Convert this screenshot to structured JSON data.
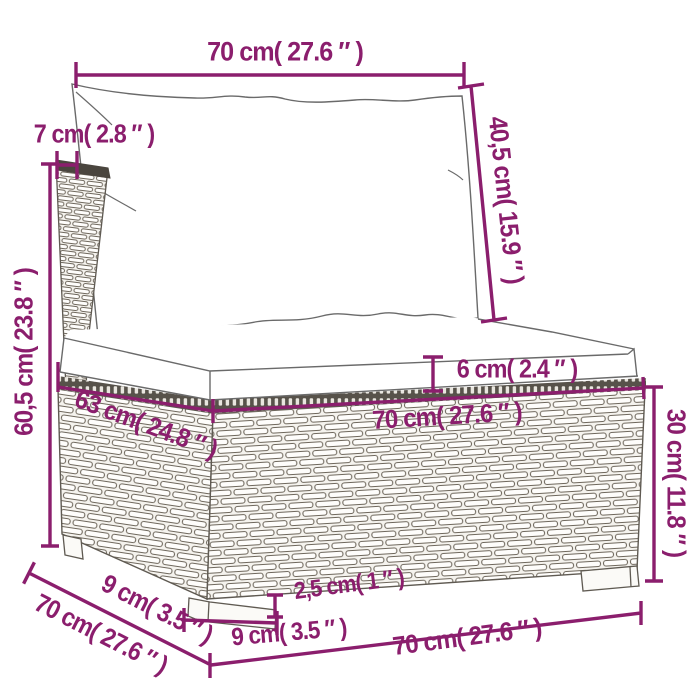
{
  "colors": {
    "accent": "#8b1e6d",
    "outline": "#5f5a52",
    "wicker_stroke": "#6e675c",
    "wicker_bg": "#f5f3ee",
    "band_dark": "#57524a",
    "cap_dark": "#4a453e"
  },
  "dimensions": {
    "top_width": {
      "text": "70 cm( 27.6 ″ )"
    },
    "back_thickness": {
      "text": "7 cm( 2.8 ″ )"
    },
    "back_height": {
      "text": "60,5 cm( 23.8 ″ )"
    },
    "back_cushion_height": {
      "text": "40,5 cm( 15.9 ″ )"
    },
    "seat_cushion_thickness": {
      "text": "6 cm( 2.4 ″ )"
    },
    "seat_depth": {
      "text": "63 cm( 24.8 ″ )"
    },
    "seat_width": {
      "text": "70 cm( 27.6 ″ )"
    },
    "base_height": {
      "text": "30 cm( 11.8 ″ )"
    },
    "foot_side_width": {
      "text": "9 cm( 3.5 ″ )"
    },
    "bottom_depth": {
      "text": "70 cm( 27.6 ″ )"
    },
    "foot_height": {
      "text": "2,5 cm( 1 ″ )"
    },
    "foot_front_width": {
      "text": "9 cm( 3.5 ″ )"
    },
    "bottom_width": {
      "text": "70 cm( 27.6 ″ )"
    }
  }
}
